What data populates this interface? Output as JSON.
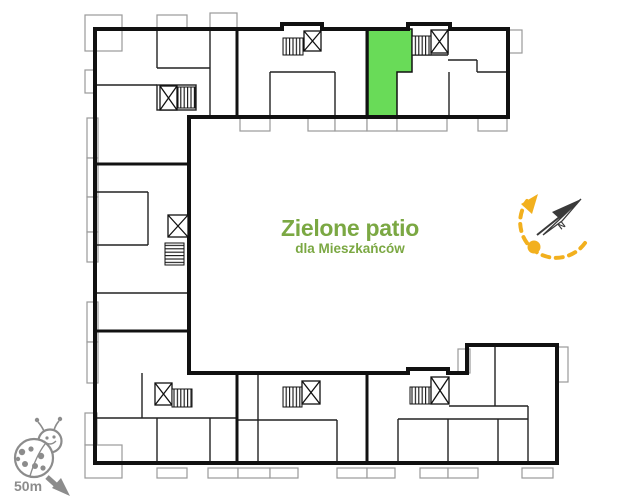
{
  "patio": {
    "title": "Zielone patio",
    "subtitle": "dla Mieszkańców"
  },
  "compass": {
    "north_label": "N"
  },
  "scale": {
    "label": "50m"
  },
  "icons": {
    "north_arrow": "compass-needle with dashed rotation arc and dot",
    "ladybug": "ladybug mascot used as map scale marker",
    "scale_arrow": "arrow pointing south-east",
    "staircase": "crossed-square with stair treads (7 stairwells on plan)"
  },
  "colors": {
    "highlight_green": "#69DB58",
    "title_green": "#7BA843",
    "accent_yellow": "#F2B01E",
    "icon_gray": "#8C8C8C",
    "wall_black": "#111111",
    "balcony_gray": "#9A9A9A"
  }
}
